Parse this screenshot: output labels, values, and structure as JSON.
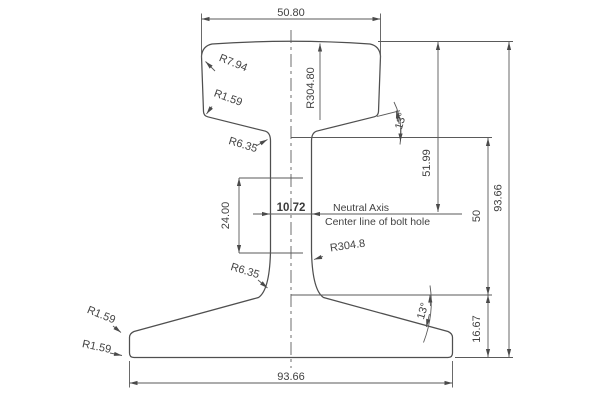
{
  "drawing": {
    "type": "rail-cross-section-technical-drawing",
    "colors": {
      "background": "#ffffff",
      "line": "#5a5a5a",
      "profile": "#4f4f4f",
      "text": "#414141"
    },
    "dims": {
      "head_width": "50.80",
      "crown_radius": "R304.80",
      "head_corner_radius": "R7.94",
      "head_lower_corner_radius": "R1.59",
      "head_web_fillet_radius": "R6.35",
      "web_gauge_height": "24.00",
      "web_thickness": "10.72",
      "web_face_radius": "R304.8",
      "web_base_fillet_radius": "R6.35",
      "base_tip_top_radius": "R1.59",
      "base_tip_bottom_radius": "R1.59",
      "head_underside_angle": "13°",
      "base_top_angle": "13°",
      "neutral_axis_depth": "51.99",
      "lower_section_height": "50",
      "base_edge_height": "16.67",
      "overall_height": "93.66",
      "base_width": "93.66"
    },
    "labels": {
      "neutral_axis": "Neutral Axis",
      "bolt_hole_center": "Center line of bolt hole"
    }
  }
}
